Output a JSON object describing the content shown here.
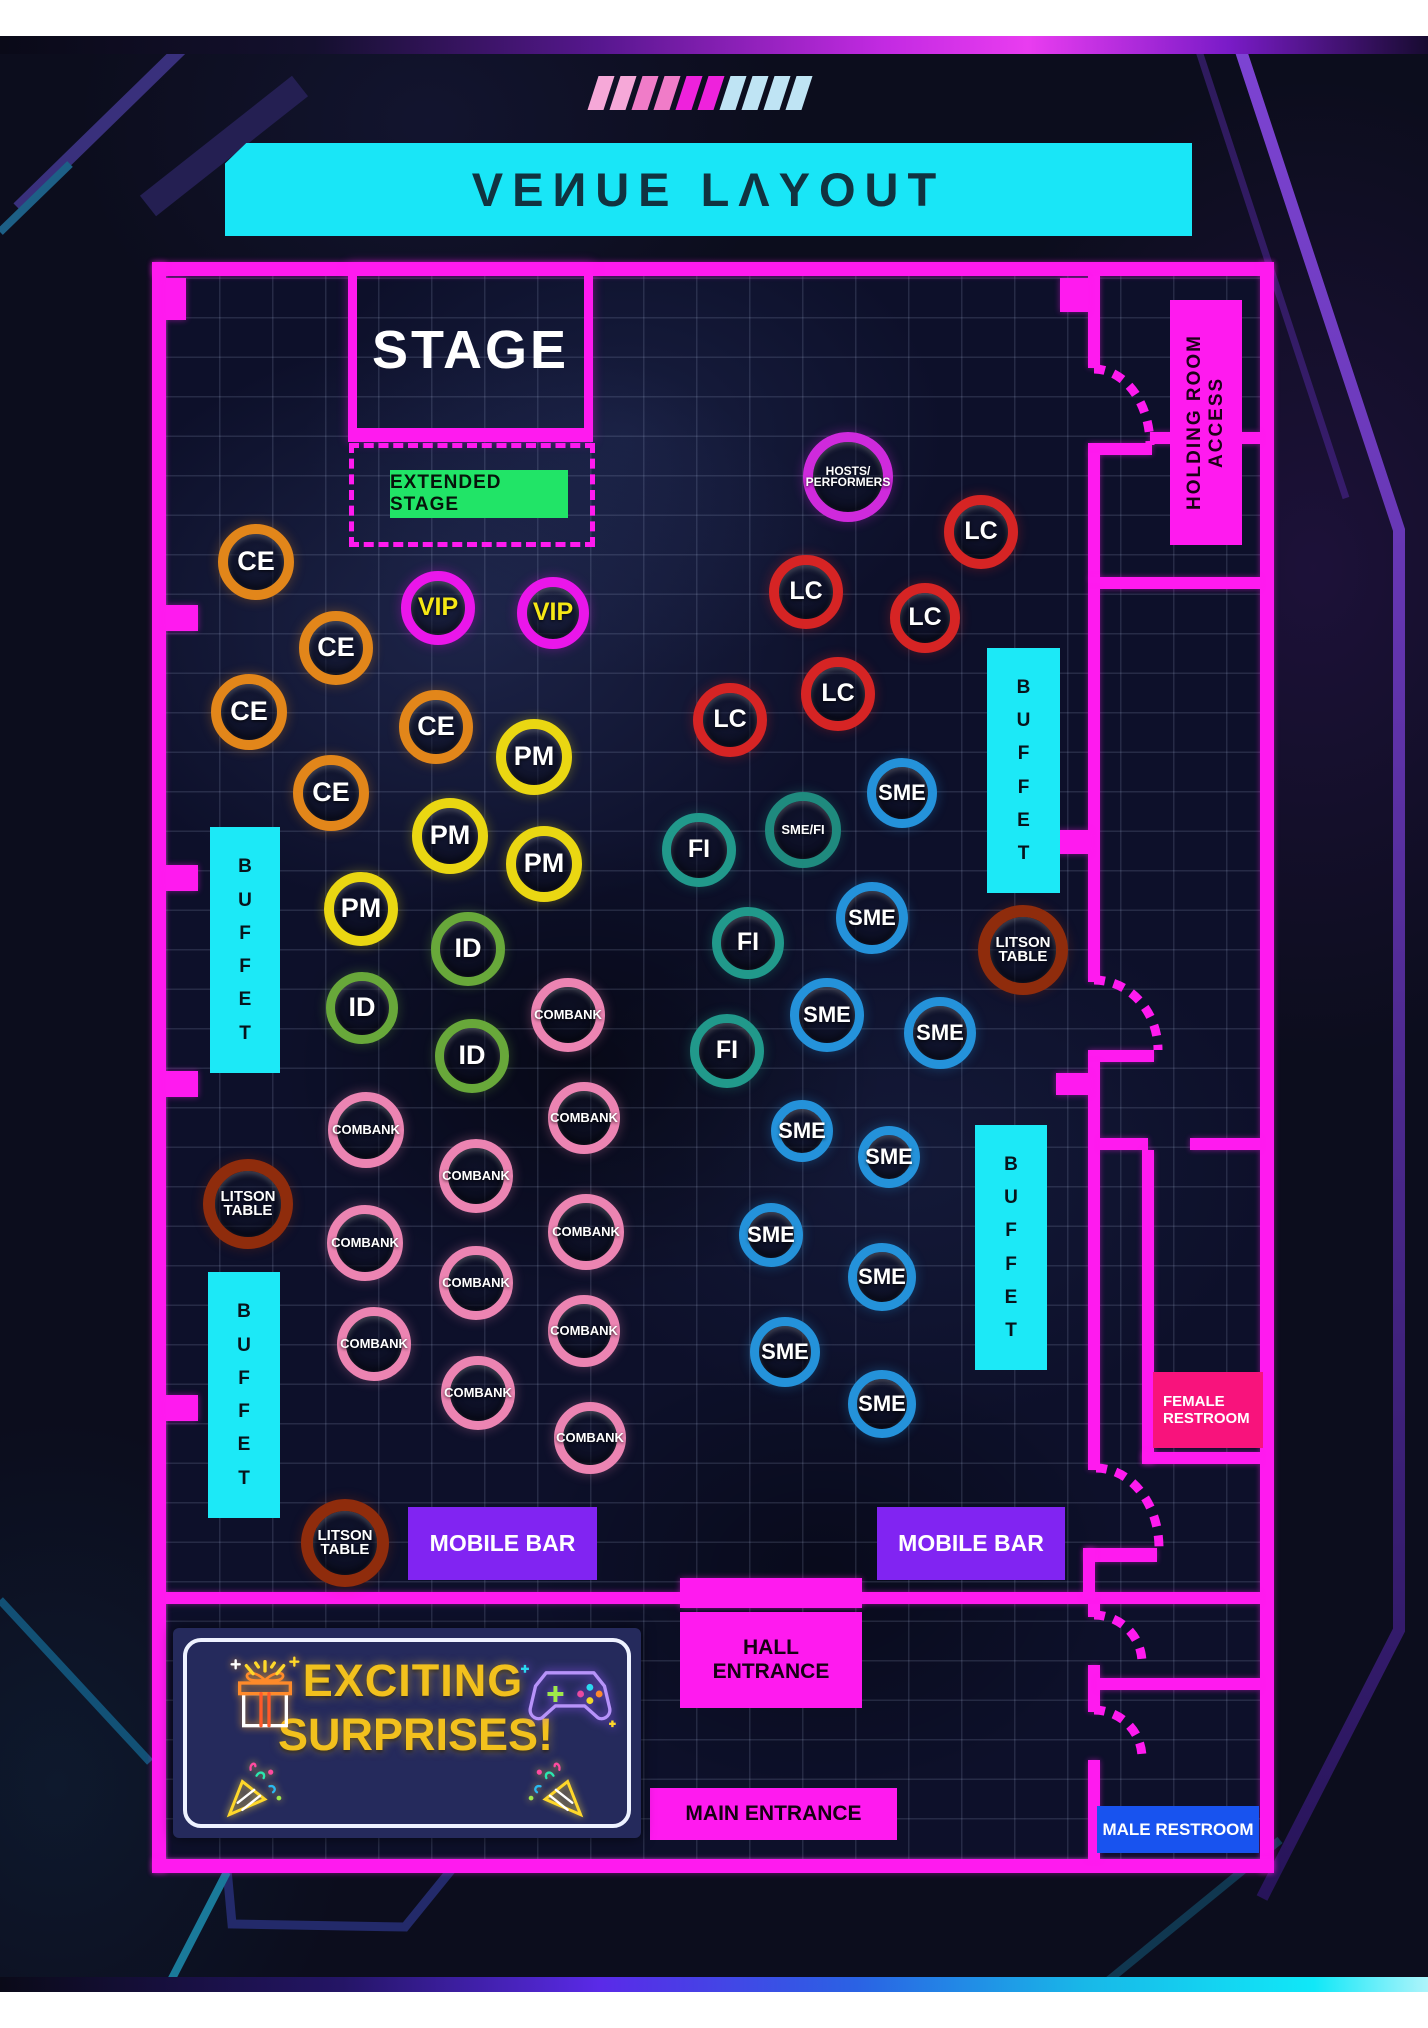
{
  "title": "VEИUE LΛYOUT",
  "stage": {
    "label": "STAGE"
  },
  "extended_stage": {
    "label": "EXTENDED STAGE"
  },
  "surprises": {
    "line1": "EXCITING",
    "line2": "SURPRISES!"
  },
  "colors": {
    "wall": "#ff1aef",
    "cyan": "#1ce9f7",
    "stage_green": "#21e467",
    "mobile_bar": "#8124f2",
    "male_restroom": "#1853ef",
    "female_restroom": "#f8137c",
    "banner_yellow": "#f2c11d"
  },
  "table_types": {
    "CE": {
      "ring": "#e2861a",
      "text": "#ffffff",
      "fs": 27,
      "bw": 10
    },
    "VIP": {
      "ring": "#ea16ea",
      "text": "#f5e715",
      "fs": 25,
      "bw": 10
    },
    "PM": {
      "ring": "#ead712",
      "text": "#ffffff",
      "fs": 27,
      "bw": 10
    },
    "ID": {
      "ring": "#68a83a",
      "text": "#ffffff",
      "fs": 27,
      "bw": 9
    },
    "LC": {
      "ring": "#d62424",
      "text": "#ffffff",
      "fs": 25,
      "bw": 10
    },
    "SME": {
      "ring": "#2492da",
      "text": "#ffffff",
      "fs": 22,
      "bw": 9
    },
    "FI": {
      "ring": "#21998b",
      "text": "#ffffff",
      "fs": 25,
      "bw": 9
    },
    "SMEFI": {
      "ring": "#1f8a7e",
      "text": "#ffffff",
      "fs": 13,
      "bw": 9
    },
    "COMBANK": {
      "ring": "#ec84b2",
      "text": "#ffffff",
      "fs": 13,
      "bw": 9
    },
    "LITSON": {
      "ring": "#8f2c0c",
      "text": "#ffffff",
      "fs": 15,
      "bw": 12
    },
    "HOSTS": {
      "ring": "#cf2adc",
      "text": "#ffffff",
      "fs": 12,
      "bw": 10
    }
  },
  "tables": [
    {
      "type": "HOSTS",
      "label": "HOSTS/\nPERFORMERS",
      "x": 848,
      "y": 477,
      "r": 45
    },
    {
      "type": "CE",
      "label": "CE",
      "x": 256,
      "y": 562,
      "r": 38
    },
    {
      "type": "CE",
      "label": "CE",
      "x": 336,
      "y": 648,
      "r": 37
    },
    {
      "type": "CE",
      "label": "CE",
      "x": 249,
      "y": 712,
      "r": 38
    },
    {
      "type": "CE",
      "label": "CE",
      "x": 436,
      "y": 727,
      "r": 37
    },
    {
      "type": "CE",
      "label": "CE",
      "x": 331,
      "y": 793,
      "r": 38
    },
    {
      "type": "VIP",
      "label": "VIP",
      "x": 438,
      "y": 608,
      "r": 37
    },
    {
      "type": "VIP",
      "label": "VIP",
      "x": 553,
      "y": 613,
      "r": 36
    },
    {
      "type": "PM",
      "label": "PM",
      "x": 534,
      "y": 757,
      "r": 38
    },
    {
      "type": "PM",
      "label": "PM",
      "x": 450,
      "y": 836,
      "r": 38
    },
    {
      "type": "PM",
      "label": "PM",
      "x": 544,
      "y": 864,
      "r": 38
    },
    {
      "type": "PM",
      "label": "PM",
      "x": 361,
      "y": 909,
      "r": 37
    },
    {
      "type": "ID",
      "label": "ID",
      "x": 468,
      "y": 949,
      "r": 37
    },
    {
      "type": "ID",
      "label": "ID",
      "x": 362,
      "y": 1008,
      "r": 36
    },
    {
      "type": "ID",
      "label": "ID",
      "x": 472,
      "y": 1056,
      "r": 37
    },
    {
      "type": "LC",
      "label": "LC",
      "x": 981,
      "y": 532,
      "r": 37
    },
    {
      "type": "LC",
      "label": "LC",
      "x": 806,
      "y": 592,
      "r": 37
    },
    {
      "type": "LC",
      "label": "LC",
      "x": 925,
      "y": 618,
      "r": 35
    },
    {
      "type": "LC",
      "label": "LC",
      "x": 838,
      "y": 694,
      "r": 37
    },
    {
      "type": "LC",
      "label": "LC",
      "x": 730,
      "y": 720,
      "r": 37
    },
    {
      "type": "SMEFI",
      "label": "SME/FI",
      "x": 803,
      "y": 830,
      "r": 38
    },
    {
      "type": "FI",
      "label": "FI",
      "x": 699,
      "y": 850,
      "r": 37
    },
    {
      "type": "FI",
      "label": "FI",
      "x": 748,
      "y": 943,
      "r": 36
    },
    {
      "type": "FI",
      "label": "FI",
      "x": 727,
      "y": 1051,
      "r": 37
    },
    {
      "type": "SME",
      "label": "SME",
      "x": 902,
      "y": 793,
      "r": 35
    },
    {
      "type": "SME",
      "label": "SME",
      "x": 872,
      "y": 918,
      "r": 36
    },
    {
      "type": "SME",
      "label": "SME",
      "x": 827,
      "y": 1015,
      "r": 37
    },
    {
      "type": "SME",
      "label": "SME",
      "x": 940,
      "y": 1033,
      "r": 36
    },
    {
      "type": "SME",
      "label": "SME",
      "x": 802,
      "y": 1131,
      "r": 31
    },
    {
      "type": "SME",
      "label": "SME",
      "x": 889,
      "y": 1157,
      "r": 31
    },
    {
      "type": "SME",
      "label": "SME",
      "x": 771,
      "y": 1235,
      "r": 32
    },
    {
      "type": "SME",
      "label": "SME",
      "x": 882,
      "y": 1277,
      "r": 34
    },
    {
      "type": "SME",
      "label": "SME",
      "x": 785,
      "y": 1352,
      "r": 35
    },
    {
      "type": "SME",
      "label": "SME",
      "x": 882,
      "y": 1404,
      "r": 34
    },
    {
      "type": "COMBANK",
      "label": "COMBANK",
      "x": 568,
      "y": 1015,
      "r": 37
    },
    {
      "type": "COMBANK",
      "label": "COMBANK",
      "x": 584,
      "y": 1118,
      "r": 36
    },
    {
      "type": "COMBANK",
      "label": "COMBANK",
      "x": 366,
      "y": 1130,
      "r": 38
    },
    {
      "type": "COMBANK",
      "label": "COMBANK",
      "x": 476,
      "y": 1176,
      "r": 37
    },
    {
      "type": "COMBANK",
      "label": "COMBANK",
      "x": 586,
      "y": 1232,
      "r": 38
    },
    {
      "type": "COMBANK",
      "label": "COMBANK",
      "x": 365,
      "y": 1243,
      "r": 38
    },
    {
      "type": "COMBANK",
      "label": "COMBANK",
      "x": 476,
      "y": 1283,
      "r": 37
    },
    {
      "type": "COMBANK",
      "label": "COMBANK",
      "x": 584,
      "y": 1331,
      "r": 36
    },
    {
      "type": "COMBANK",
      "label": "COMBANK",
      "x": 374,
      "y": 1344,
      "r": 37
    },
    {
      "type": "COMBANK",
      "label": "COMBANK",
      "x": 478,
      "y": 1393,
      "r": 37
    },
    {
      "type": "COMBANK",
      "label": "COMBANK",
      "x": 590,
      "y": 1438,
      "r": 36
    },
    {
      "type": "LITSON",
      "label": "LITSON\nTABLE",
      "x": 1023,
      "y": 950,
      "r": 45
    },
    {
      "type": "LITSON",
      "label": "LITSON\nTABLE",
      "x": 248,
      "y": 1204,
      "r": 45
    },
    {
      "type": "LITSON",
      "label": "LITSON\nTABLE",
      "x": 345,
      "y": 1543,
      "r": 44
    }
  ],
  "zones": [
    {
      "id": "buffet-left-1",
      "label": "BUFFET",
      "x": 210,
      "y": 827,
      "w": 70,
      "h": 246,
      "fill": "#1ce9f7",
      "text": "#07141c",
      "fs": 19,
      "vertical": true
    },
    {
      "id": "buffet-left-2",
      "label": "BUFFET",
      "x": 208,
      "y": 1272,
      "w": 72,
      "h": 246,
      "fill": "#1ce9f7",
      "text": "#07141c",
      "fs": 19,
      "vertical": true
    },
    {
      "id": "buffet-right-1",
      "label": "BUFFET",
      "x": 987,
      "y": 648,
      "w": 73,
      "h": 245,
      "fill": "#1ce9f7",
      "text": "#07141c",
      "fs": 19,
      "vertical": true
    },
    {
      "id": "buffet-right-2",
      "label": "BUFFET",
      "x": 975,
      "y": 1125,
      "w": 72,
      "h": 245,
      "fill": "#1ce9f7",
      "text": "#07141c",
      "fs": 19,
      "vertical": true
    },
    {
      "id": "holding-room-access",
      "label": "HOLDING ROOM ACCESS",
      "x": 1170,
      "y": 300,
      "w": 72,
      "h": 245,
      "fill": "#ff1aef",
      "text": "#1c0117",
      "fs": 19,
      "rotated": true
    },
    {
      "id": "mobile-bar-left",
      "label": "MOBILE BAR",
      "x": 408,
      "y": 1507,
      "w": 189,
      "h": 73,
      "fill": "#8124f2",
      "text": "#ffffff",
      "fs": 23
    },
    {
      "id": "mobile-bar-right",
      "label": "MOBILE BAR",
      "x": 877,
      "y": 1507,
      "w": 188,
      "h": 73,
      "fill": "#8124f2",
      "text": "#ffffff",
      "fs": 23
    },
    {
      "id": "hall-entrance",
      "label": "HALL\nENTRANCE",
      "x": 680,
      "y": 1612,
      "w": 182,
      "h": 96,
      "fill": "#ff1aef",
      "text": "#160113",
      "fs": 21
    },
    {
      "id": "main-entrance",
      "label": "MAIN ENTRANCE",
      "x": 650,
      "y": 1788,
      "w": 247,
      "h": 52,
      "fill": "#ff1aef",
      "text": "#160113",
      "fs": 21
    },
    {
      "id": "female-restroom",
      "label": "FEMALE\nRESTROOM",
      "x": 1153,
      "y": 1372,
      "w": 110,
      "h": 76,
      "fill": "#f8137c",
      "text": "#ffffff",
      "fs": 15,
      "align": "left"
    },
    {
      "id": "male-restroom",
      "label": "MALE RESTROOM",
      "x": 1097,
      "y": 1806,
      "w": 162,
      "h": 47,
      "fill": "#1853ef",
      "text": "#ffffff",
      "fs": 17
    }
  ],
  "decor": {
    "slashes": [
      "#f6a8d8",
      "#f6a8d8",
      "#f07cc8",
      "#f07cc8",
      "#ee22dc",
      "#ee22dc",
      "#bfe4f4",
      "#bfe4f4",
      "#bfe4f4",
      "#bfe4f4"
    ]
  }
}
